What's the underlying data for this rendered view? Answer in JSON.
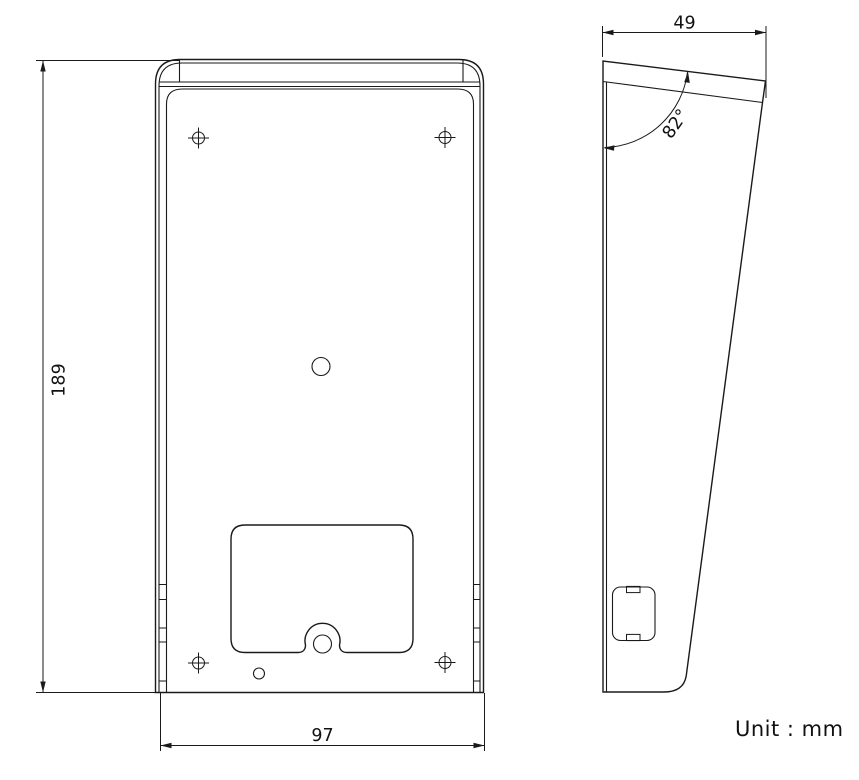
{
  "drawing": {
    "type": "technical-dimension-drawing",
    "unit_note": "Unit :  mm",
    "dimensions": {
      "height": "189",
      "width": "97",
      "depth": "49",
      "angle": "82°"
    },
    "colors": {
      "background": "#ffffff",
      "line": "#1a1a1a"
    }
  }
}
